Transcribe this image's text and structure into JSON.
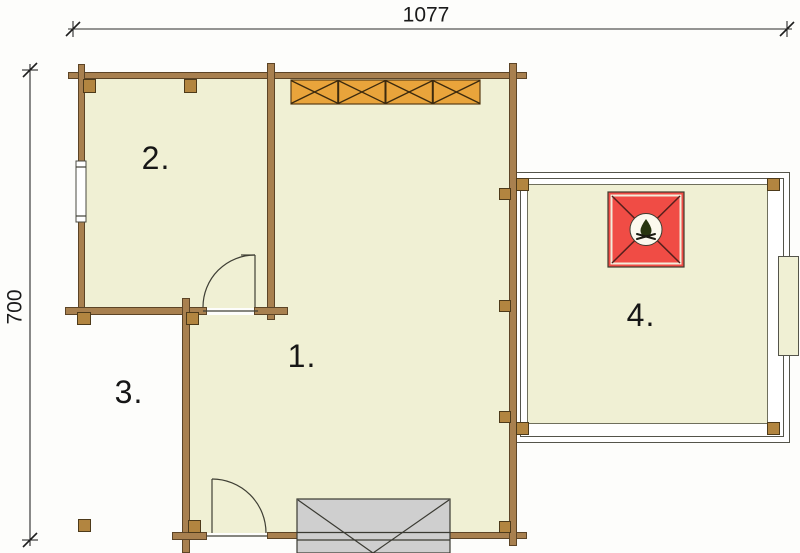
{
  "plan": {
    "dimensions": {
      "width": "1077",
      "height": "700"
    },
    "rooms": [
      {
        "id": "room-1",
        "label": "1."
      },
      {
        "id": "room-2",
        "label": "2."
      },
      {
        "id": "room-3",
        "label": "3."
      },
      {
        "id": "room-4",
        "label": "4."
      }
    ],
    "symbols": {
      "fireplace_icon": "campfire-icon",
      "pergola_beam": "cross-braced-beam",
      "stairs": "entrance-steps"
    },
    "colors": {
      "wall": "#a8804f",
      "wall_outline": "#5c4426",
      "floor": "#f0f0d4",
      "post": "#b28540",
      "beam": "#e9a43b",
      "fireplace": "#f04c45",
      "stairs": "#cfcfcf"
    }
  }
}
